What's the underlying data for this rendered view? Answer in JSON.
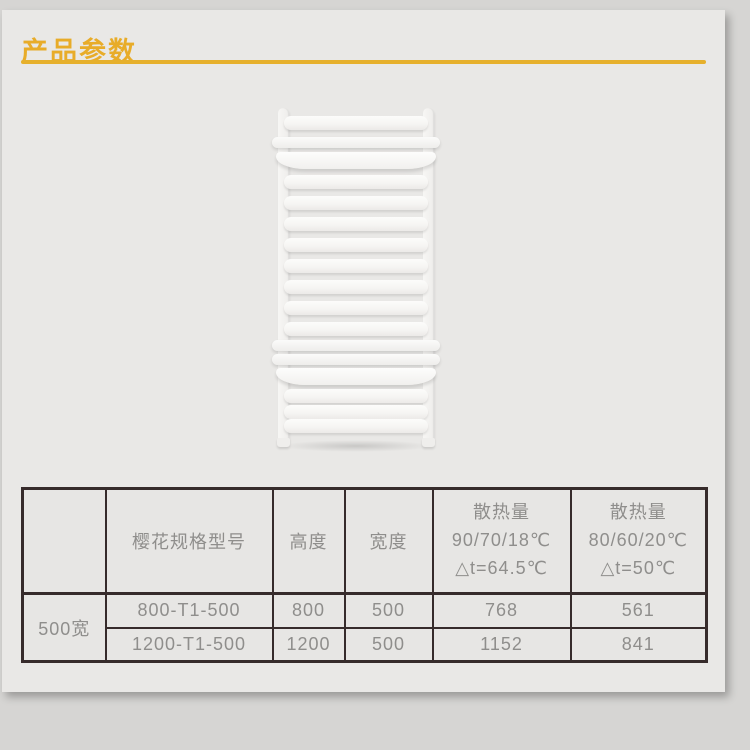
{
  "page": {
    "title": "产品参数"
  },
  "colors": {
    "accent_gold": "#e8ac29",
    "underline_gold": "#e6b02c",
    "card_background": "#e9e8e6",
    "page_background": "#d6d5d3",
    "table_border": "#362b2b",
    "table_text": "#8f8e8c"
  },
  "product_image": {
    "name": "white-towel-radiator"
  },
  "chart_data": {
    "type": "table",
    "columns": [
      "",
      "樱花规格型号",
      "高度",
      "宽度",
      "散热量 90/70/18℃ △t=64.5℃",
      "散热量 80/60/20℃ △t=50℃"
    ],
    "rows": [
      [
        "500宽",
        "800-T1-500",
        "800",
        "500",
        "768",
        "561"
      ],
      [
        "500宽",
        "1200-T1-500",
        "1200",
        "500",
        "1152",
        "841"
      ]
    ]
  },
  "table": {
    "headers": {
      "corner": "",
      "model": "樱花规格型号",
      "height": "高度",
      "width": "宽度",
      "heat_high": "散热量\n90/70/18℃\n△t=64.5℃",
      "heat_low": "散热量\n80/60/20℃\n△t=50℃"
    },
    "row_group": "500宽",
    "rows": [
      {
        "model": "800-T1-500",
        "height": "800",
        "width": "500",
        "heat_high": "768",
        "heat_low": "561"
      },
      {
        "model": "1200-T1-500",
        "height": "1200",
        "width": "500",
        "heat_high": "1152",
        "heat_low": "841"
      }
    ]
  }
}
